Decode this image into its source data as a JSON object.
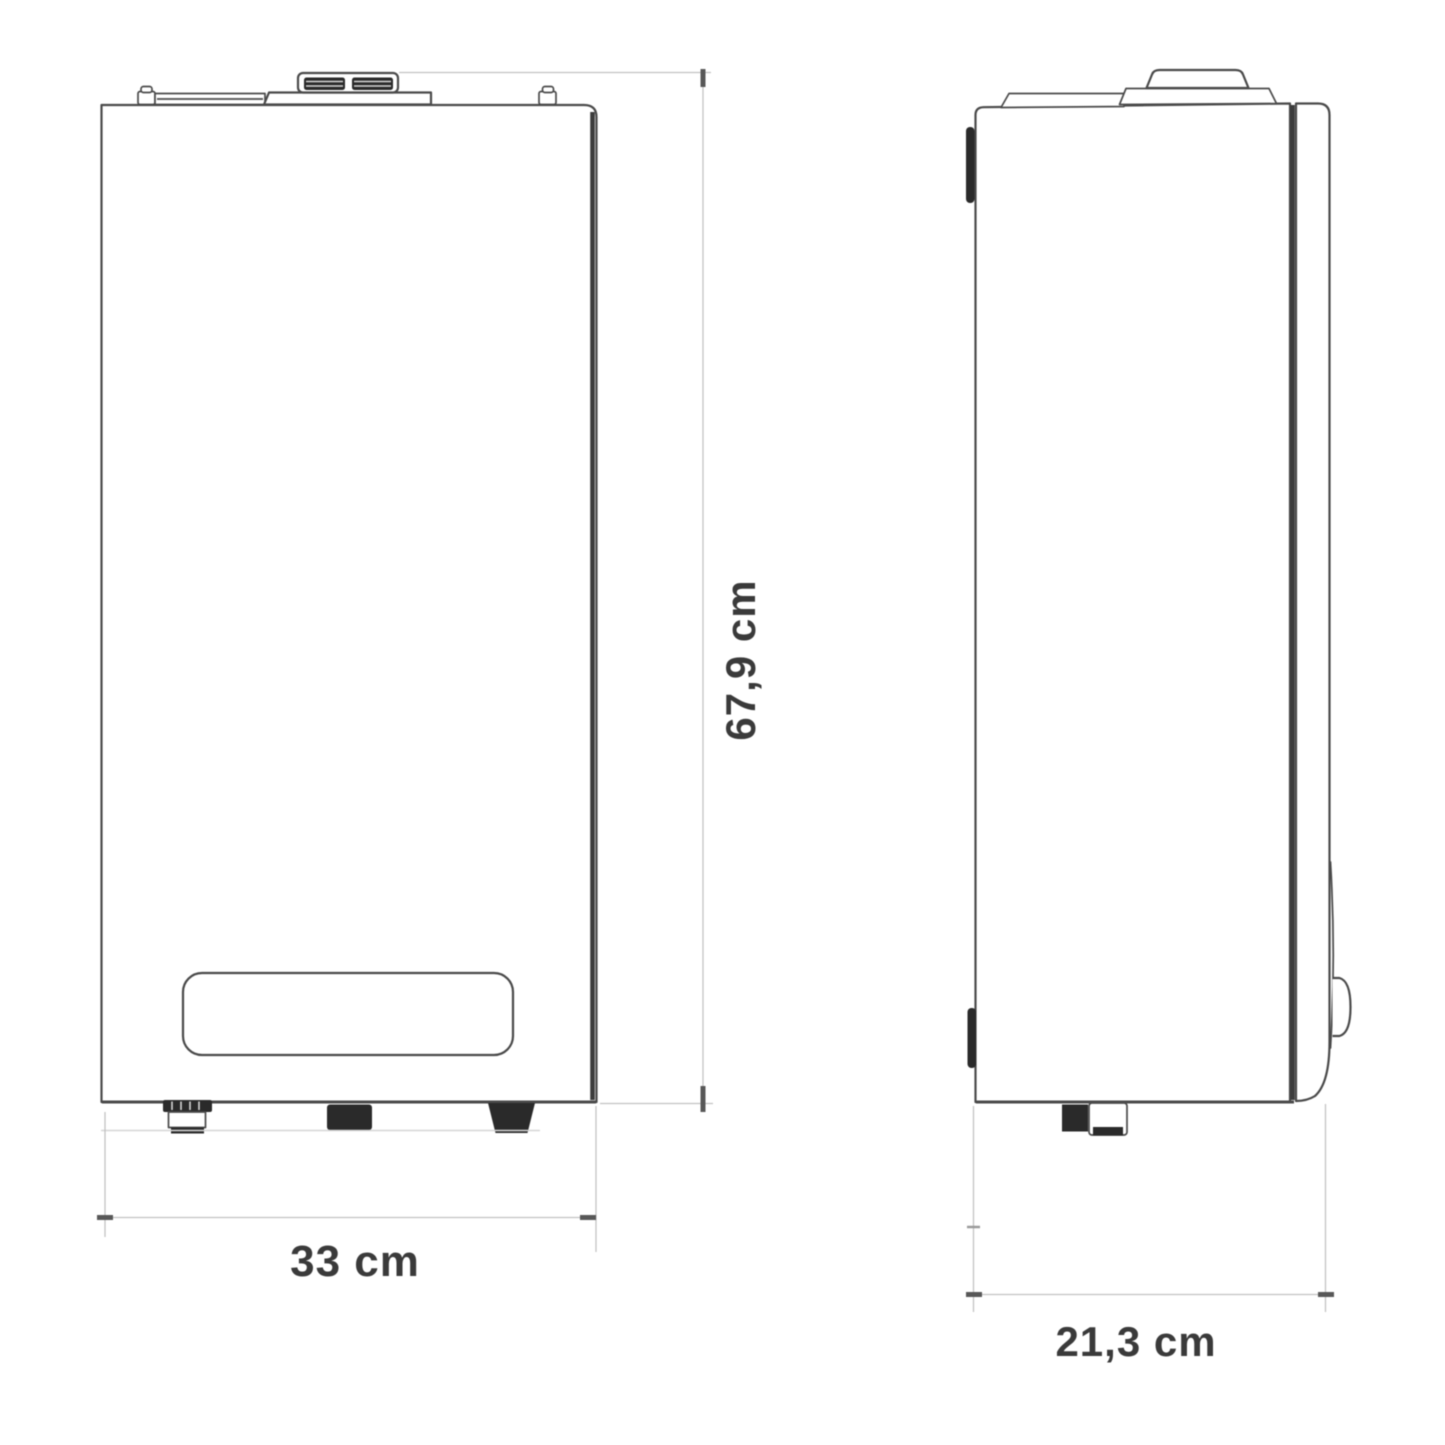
{
  "drawing": {
    "type": "technical-dimension-diagram",
    "subject": "wall-hung-boiler",
    "views": {
      "front": {
        "dimensions": {
          "height": {
            "label": "67,9 cm"
          },
          "width": {
            "label": "33 cm"
          }
        }
      },
      "side": {
        "dimensions": {
          "depth": {
            "label": "21,3 cm"
          }
        }
      }
    }
  },
  "colors": {
    "bg": "#ffffff",
    "line": "#4a4a4a",
    "line_dark": "#3c3c3c",
    "dark": "#2a2a2a",
    "dim": "#c2c2c2",
    "tick": "#585858",
    "label": "#3a3a3a"
  }
}
